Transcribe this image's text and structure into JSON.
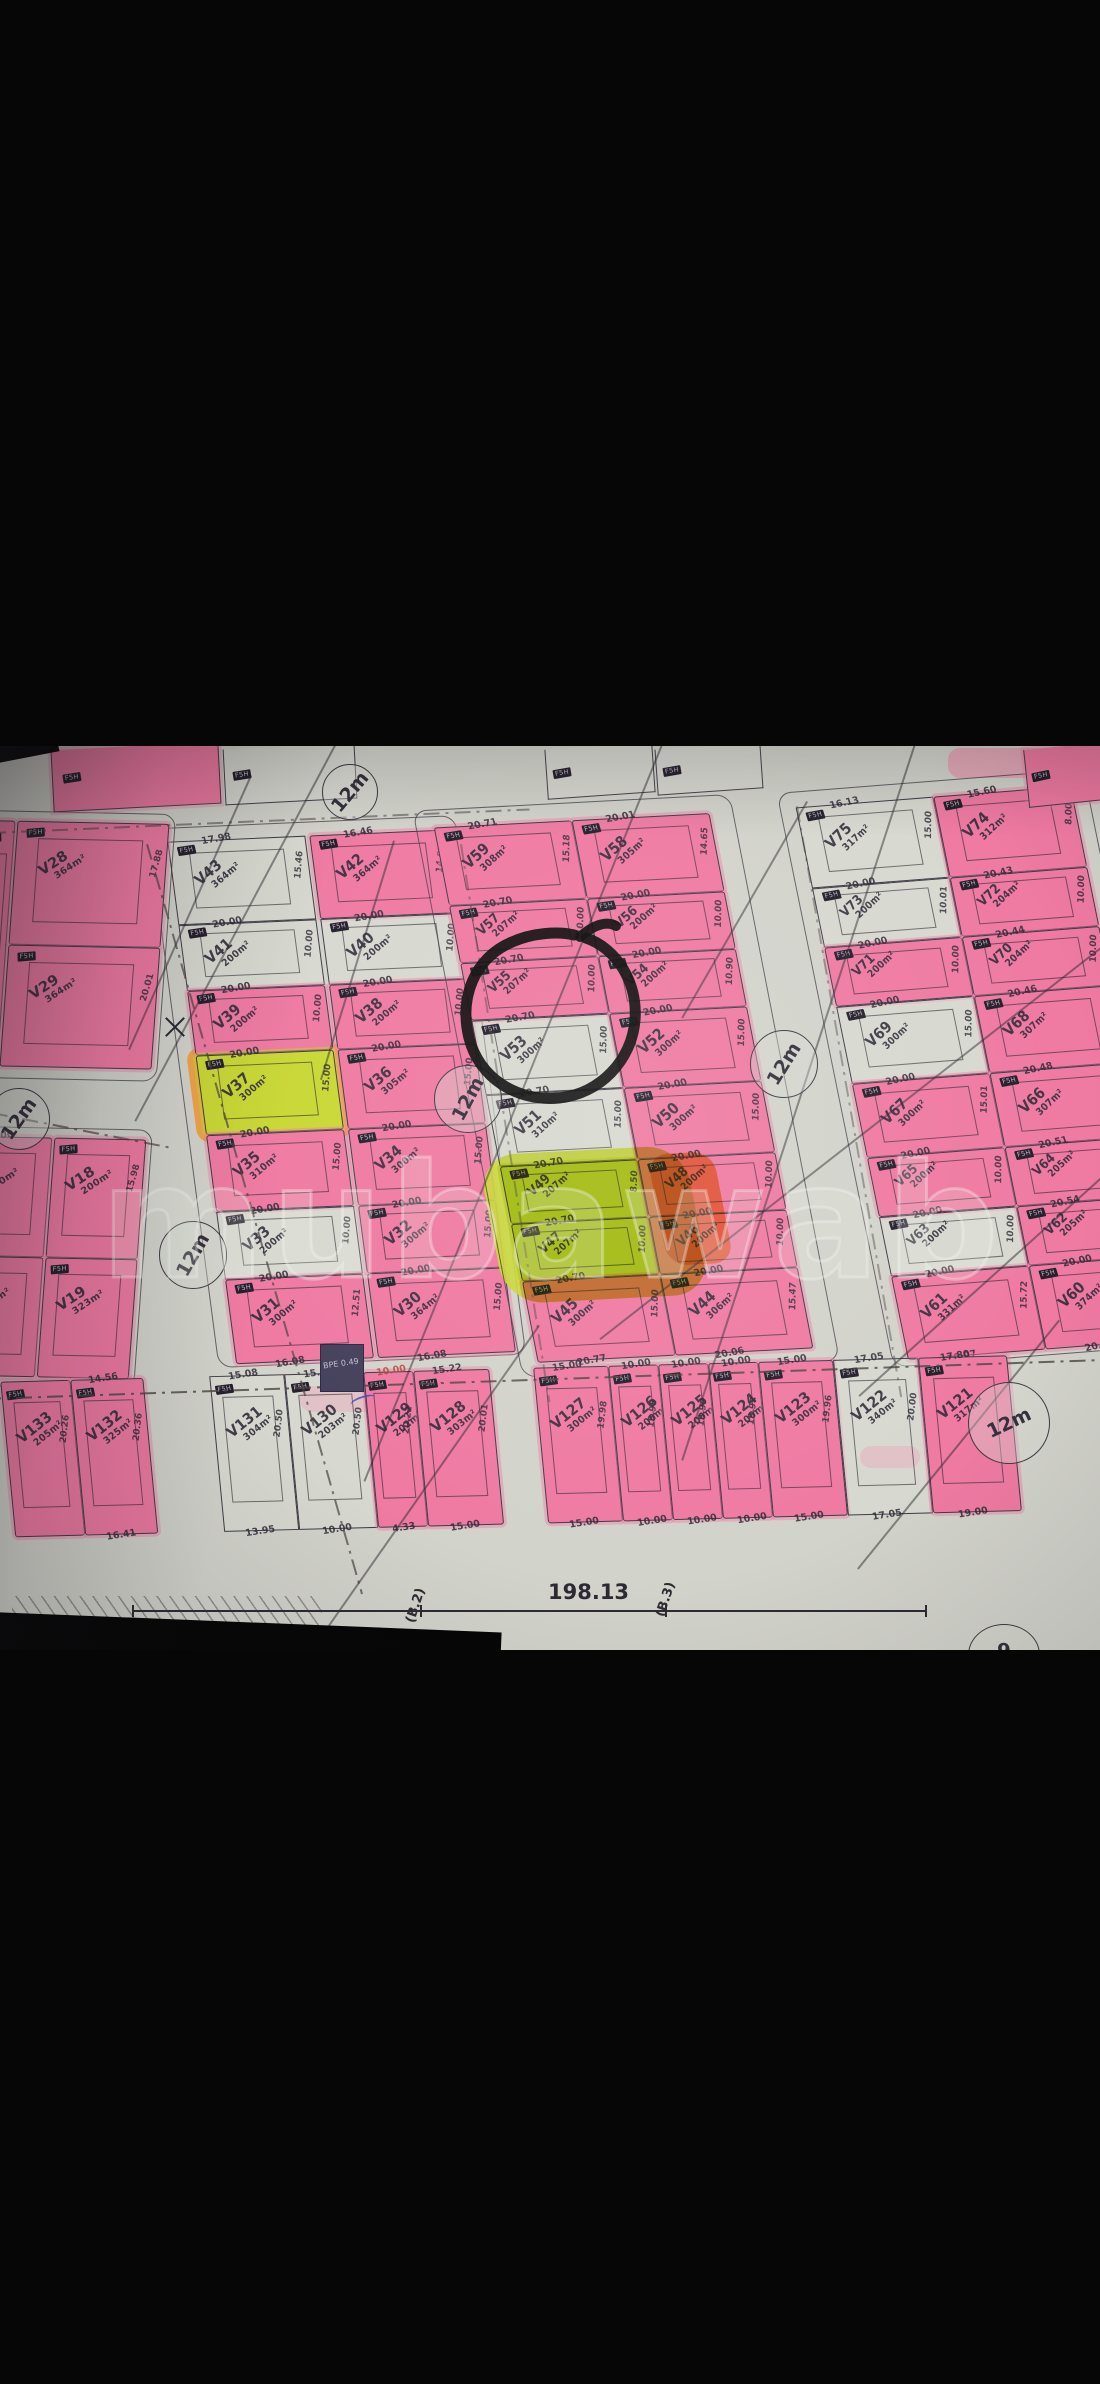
{
  "photo": {
    "watermark": "mubawab",
    "road_width_label": "12m",
    "plot_chip_label": "F5H",
    "bpe_label": "BPE 0.49",
    "boundary_total": "198.13",
    "boundary_marks": [
      "(B.2)",
      "(B.3)"
    ],
    "bottom_edge_mark": "9",
    "circled_plot": "V53",
    "colors": {
      "paper": "#d2d3cb",
      "pink_highlight": "#ef7aa2",
      "yellow_highlight": "#c9d834",
      "orange_highlight": "#f0a03c",
      "ink": "#3c3744",
      "letterbox": "#060606",
      "marker": "#0c0c0c"
    },
    "top_partials": [
      {
        "f": "pink"
      },
      {
        "f": "white"
      },
      {
        "f": "white"
      },
      {
        "f": "white"
      },
      {
        "f": "pink"
      }
    ],
    "blocks": {
      "left_upper": {
        "cols": [
          [
            {
              "v": "V28",
              "a": "364m²",
              "f": "pink",
              "s": "17.88"
            },
            {
              "v": "V29",
              "a": "364m²",
              "f": "pink",
              "s": "20.01"
            }
          ]
        ]
      },
      "left_mid": {
        "cols": [
          [
            {
              "v": "V16",
              "a": "200m²",
              "f": "pink",
              "w": "20.00"
            },
            {
              "v": "V17",
              "a": "322m²",
              "f": "pink",
              "b": "20.11"
            }
          ],
          [
            {
              "v": "V18",
              "a": "200m²",
              "f": "pink",
              "s": "15.98"
            },
            {
              "v": "V19",
              "a": "323m²",
              "f": "pink"
            }
          ]
        ]
      },
      "A": {
        "cols": [
          [
            {
              "v": "V43",
              "a": "364m²",
              "f": "white",
              "w": "17.98",
              "s": "15.46"
            },
            {
              "v": "V41",
              "a": "200m²",
              "f": "white",
              "w": "20.00",
              "s": "10.00"
            },
            {
              "v": "V39",
              "a": "200m²",
              "f": "pink",
              "w": "20.00",
              "s": "10.00"
            },
            {
              "v": "V37",
              "a": "300m²",
              "f": "yellow",
              "w": "20.00",
              "s": "15.00"
            },
            {
              "v": "V35",
              "a": "310m²",
              "f": "pink",
              "w": "20.00",
              "s": "15.00"
            },
            {
              "v": "V33",
              "a": "200m²",
              "f": "white",
              "w": "20.00",
              "s": "10.00"
            },
            {
              "v": "V31",
              "a": "300m²",
              "f": "pink",
              "w": "20.00",
              "b": "16.08",
              "s": "12.51"
            }
          ],
          [
            {
              "v": "V42",
              "a": "364m²",
              "f": "pink",
              "w": "16.46",
              "s": "14.81"
            },
            {
              "v": "V40",
              "a": "200m²",
              "f": "white",
              "w": "20.00",
              "s": "10.00"
            },
            {
              "v": "V38",
              "a": "200m²",
              "f": "pink",
              "w": "20.00",
              "s": "10.00"
            },
            {
              "v": "V36",
              "a": "305m²",
              "f": "pink",
              "w": "20.00",
              "s": "15.00"
            },
            {
              "v": "V34",
              "a": "300m²",
              "f": "pink",
              "w": "20.00",
              "s": "15.00"
            },
            {
              "v": "V32",
              "a": "300m²",
              "f": "pink",
              "w": "20.00",
              "s": "15.00"
            },
            {
              "v": "V30",
              "a": "364m²",
              "f": "pink",
              "w": "20.00",
              "b": "16.08",
              "s": "15.00"
            }
          ]
        ]
      },
      "B": {
        "cols": [
          [
            {
              "v": "V59",
              "a": "308m²",
              "f": "pink",
              "w": "20.71",
              "s": "15.18"
            },
            {
              "v": "V57",
              "a": "207m²",
              "f": "pink",
              "w": "20.70",
              "s": "10.00"
            },
            {
              "v": "V55",
              "a": "207m²",
              "f": "pink",
              "w": "20.70",
              "s": "10.00"
            },
            {
              "v": "V53",
              "a": "300m²",
              "f": "white",
              "w": "20.70",
              "s": "15.00"
            },
            {
              "v": "V51",
              "a": "310m²",
              "f": "white",
              "w": "20.70",
              "s": "15.00"
            },
            {
              "v": "V49",
              "a": "207m²",
              "f": "yellow",
              "w": "20.70",
              "s": "8.50"
            },
            {
              "v": "V47",
              "a": "207m²",
              "f": "yellow",
              "w": "20.70",
              "s": "10.00"
            },
            {
              "v": "V45",
              "a": "300m²",
              "f": "pink",
              "w": "20.70",
              "b": "20.77",
              "s": "15.00"
            }
          ],
          [
            {
              "v": "V58",
              "a": "305m²",
              "f": "pink",
              "w": "20.01",
              "s": "14.65"
            },
            {
              "v": "V56",
              "a": "200m²",
              "f": "pink",
              "w": "20.00",
              "s": "10.00"
            },
            {
              "v": "V54",
              "a": "200m²",
              "f": "pink",
              "w": "20.00",
              "s": "10.90"
            },
            {
              "v": "V52",
              "a": "300m²",
              "f": "pink",
              "w": "20.00",
              "s": "15.00"
            },
            {
              "v": "V50",
              "a": "300m²",
              "f": "pink",
              "w": "20.00",
              "s": "15.00"
            },
            {
              "v": "V48",
              "a": "200m²",
              "f": "pink",
              "w": "20.00",
              "s": "10.00"
            },
            {
              "v": "V46",
              "a": "200m²",
              "f": "pink",
              "w": "20.00",
              "s": "10.00"
            },
            {
              "v": "V44",
              "a": "306m²",
              "f": "pink",
              "w": "20.00",
              "b": "20.06",
              "s": "15.47"
            }
          ]
        ]
      },
      "C": {
        "cols": [
          [
            {
              "v": "V75",
              "a": "317m²",
              "f": "white",
              "w": "16.13",
              "s": "15.00"
            },
            {
              "v": "V73",
              "a": "200m²",
              "f": "white",
              "w": "20.00",
              "s": "10.01"
            },
            {
              "v": "V71",
              "a": "200m²",
              "f": "pink",
              "w": "20.00",
              "s": "10.00"
            },
            {
              "v": "V69",
              "a": "300m²",
              "f": "white",
              "w": "20.00",
              "s": "15.00"
            },
            {
              "v": "V67",
              "a": "300m²",
              "f": "pink",
              "w": "20.00",
              "s": "15.01"
            },
            {
              "v": "V65",
              "a": "200m²",
              "f": "pink",
              "w": "20.00",
              "s": "10.00"
            },
            {
              "v": "V63",
              "a": "200m²",
              "f": "white",
              "w": "20.00",
              "s": "10.00"
            },
            {
              "v": "V61",
              "a": "331m²",
              "f": "pink",
              "w": "20.00",
              "b": "20.07",
              "s": "15.72"
            }
          ],
          [
            {
              "v": "V74",
              "a": "312m²",
              "f": "pink",
              "w": "15.60",
              "s": "8.00"
            },
            {
              "v": "V72",
              "a": "204m²",
              "f": "pink",
              "w": "20.43",
              "s": "10.00"
            },
            {
              "v": "V70",
              "a": "204m²",
              "f": "pink",
              "w": "20.44",
              "s": "10.00"
            },
            {
              "v": "V68",
              "a": "307m²",
              "f": "pink",
              "w": "20.46",
              "s": "15.00"
            },
            {
              "v": "V66",
              "a": "307m²",
              "f": "pink",
              "w": "20.48",
              "s": "15.00"
            },
            {
              "v": "V64",
              "a": "205m²",
              "f": "pink",
              "w": "20.51",
              "s": "10.00"
            },
            {
              "v": "V62",
              "a": "205m²",
              "f": "pink",
              "w": "20.54",
              "s": "10.00"
            },
            {
              "v": "V60",
              "a": "374m²",
              "f": "pink",
              "w": "20.00",
              "b": "20.64",
              "s": "15.00"
            }
          ]
        ]
      }
    },
    "bottom_row": {
      "plots": [
        {
          "v": "V133",
          "a": "205m²",
          "f": "pink",
          "s": "20.26"
        },
        {
          "v": "V132",
          "a": "325m²",
          "f": "pink",
          "w": "14.56",
          "b": "16.41",
          "s": "20.36"
        },
        {
          "v": "V131",
          "a": "304m²",
          "f": "white",
          "w": "15.08",
          "b": "13.95",
          "s": "20.50"
        },
        {
          "v": "V130",
          "a": "203m²",
          "f": "white",
          "w": "15.86",
          "b": "10.00",
          "s": "20.50"
        },
        {
          "v": "V129",
          "a": "202m²",
          "f": "pink",
          "w": "10.00",
          "wred": true,
          "b": "4.33",
          "s": "20.22"
        },
        {
          "v": "V128",
          "a": "303m²",
          "f": "pink",
          "w": "15.22",
          "b": "15.00",
          "s": "20.01"
        },
        {
          "v": "V127",
          "a": "300m²",
          "f": "pink",
          "w": "15.00",
          "b": "15.00",
          "s": "19.98"
        },
        {
          "v": "V126",
          "a": "200m²",
          "f": "pink",
          "w": "10.00",
          "b": "10.00",
          "s": "19.98"
        },
        {
          "v": "V125",
          "a": "200m²",
          "f": "pink",
          "w": "10.00",
          "b": "10.00",
          "s": "19.99"
        },
        {
          "v": "V124",
          "a": "200m²",
          "f": "pink",
          "w": "10.00",
          "b": "10.00",
          "s": "19.97"
        },
        {
          "v": "V123",
          "a": "300m²",
          "f": "pink",
          "w": "15.00",
          "b": "15.00",
          "s": "19.96"
        },
        {
          "v": "V122",
          "a": "340m²",
          "f": "white",
          "w": "17.05",
          "b": "17.05",
          "s": "20.00"
        },
        {
          "v": "V121",
          "a": "317m²",
          "f": "pink",
          "w": "17.80",
          "b": "19.00"
        }
      ]
    }
  }
}
